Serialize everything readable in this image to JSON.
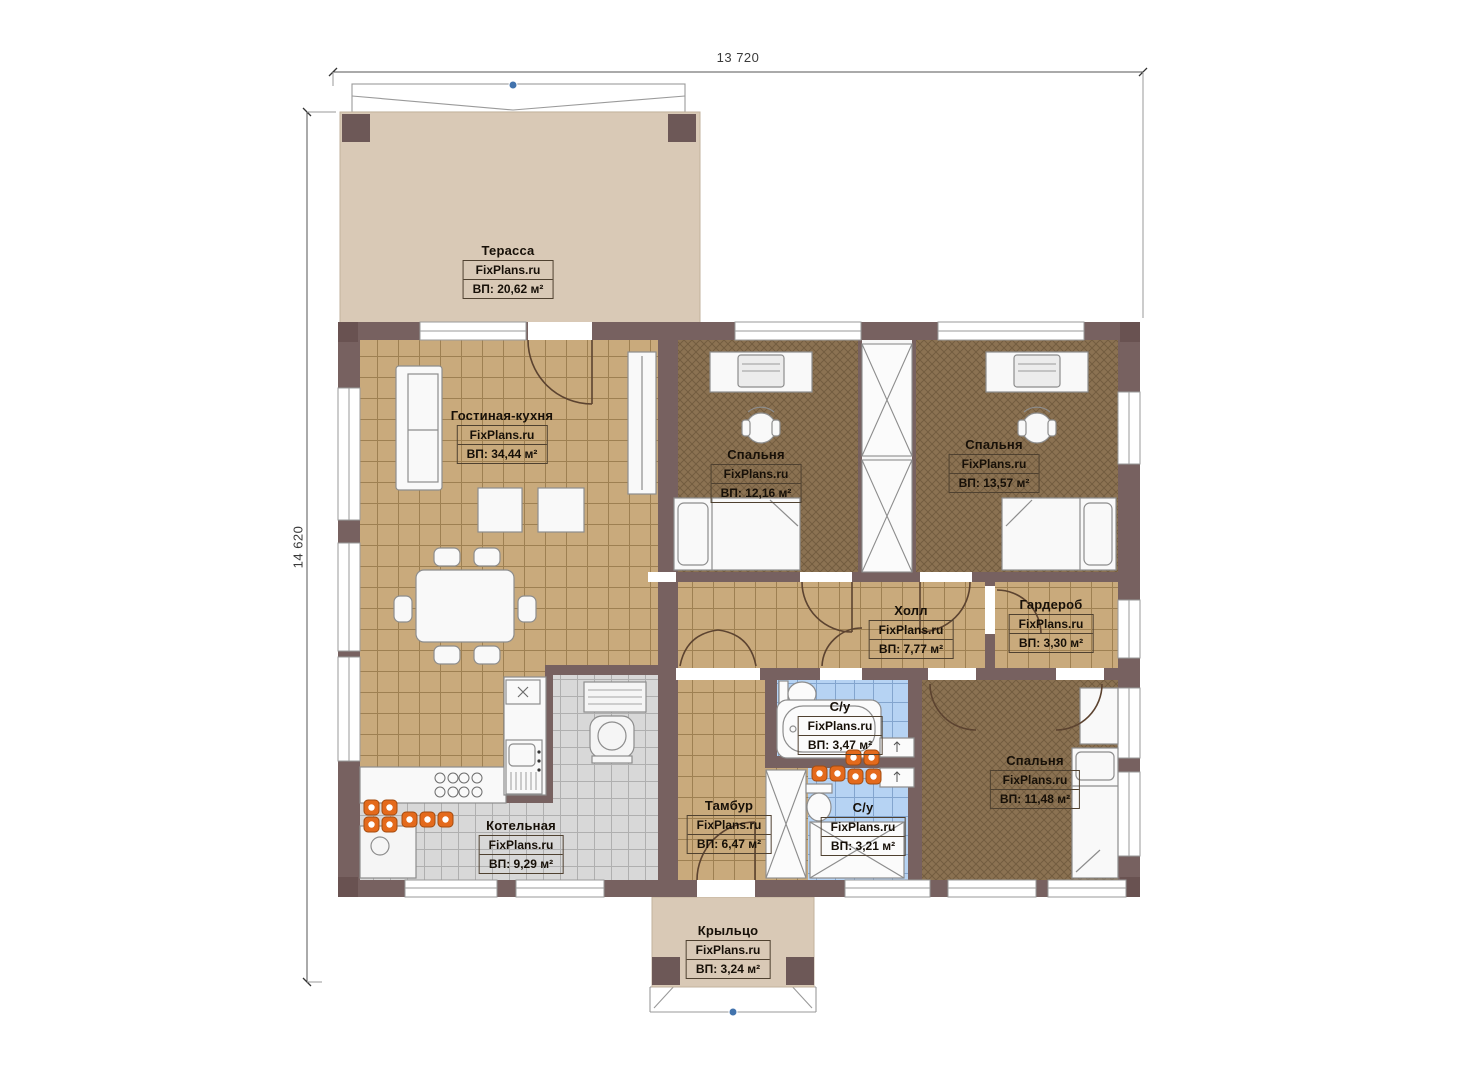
{
  "dimensions": {
    "width_label": "13 720",
    "height_label": "14 620"
  },
  "rooms": [
    {
      "id": "terrace",
      "name": "Терасса",
      "brand": "FixPlans.ru",
      "area": "ВП: 20,62 м²"
    },
    {
      "id": "living-kitchen",
      "name": "Гостиная-кухня",
      "brand": "FixPlans.ru",
      "area": "ВП: 34,44 м²"
    },
    {
      "id": "bedroom-1",
      "name": "Спальня",
      "brand": "FixPlans.ru",
      "area": "ВП: 12,16 м²"
    },
    {
      "id": "bedroom-2",
      "name": "Спальня",
      "brand": "FixPlans.ru",
      "area": "ВП: 13,57 м²"
    },
    {
      "id": "hall",
      "name": "Холл",
      "brand": "FixPlans.ru",
      "area": "ВП: 7,77 м²"
    },
    {
      "id": "wardrobe",
      "name": "Гардероб",
      "brand": "FixPlans.ru",
      "area": "ВП: 3,30 м²"
    },
    {
      "id": "bathroom-1",
      "name": "С/у",
      "brand": "FixPlans.ru",
      "area": "ВП: 3,47 м²"
    },
    {
      "id": "bathroom-2",
      "name": "С/у",
      "brand": "FixPlans.ru",
      "area": "ВП: 3,21 м²"
    },
    {
      "id": "bedroom-3",
      "name": "Спальня",
      "brand": "FixPlans.ru",
      "area": "ВП: 11,48 м²"
    },
    {
      "id": "vestibule",
      "name": "Тамбур",
      "brand": "FixPlans.ru",
      "area": "ВП: 6,47 м²"
    },
    {
      "id": "boiler-room",
      "name": "Котельная",
      "brand": "FixPlans.ru",
      "area": "ВП: 9,29 м²"
    },
    {
      "id": "porch",
      "name": "Крыльцо",
      "brand": "FixPlans.ru",
      "area": "ВП: 3,24 м²"
    }
  ],
  "colors": {
    "wall": "#776160",
    "wall_pad": "#695251",
    "terrace_deck": "#d9c9b6",
    "tile_tan": "#c9aa7c",
    "carpet_brown": "#8b7252",
    "tile_blue": "#b6d3f3",
    "tile_gray": "#d8d8d8",
    "radiator_orange": "#e46a1c",
    "marker_blue": "#4273ad",
    "door_swing": "#5c4330"
  }
}
